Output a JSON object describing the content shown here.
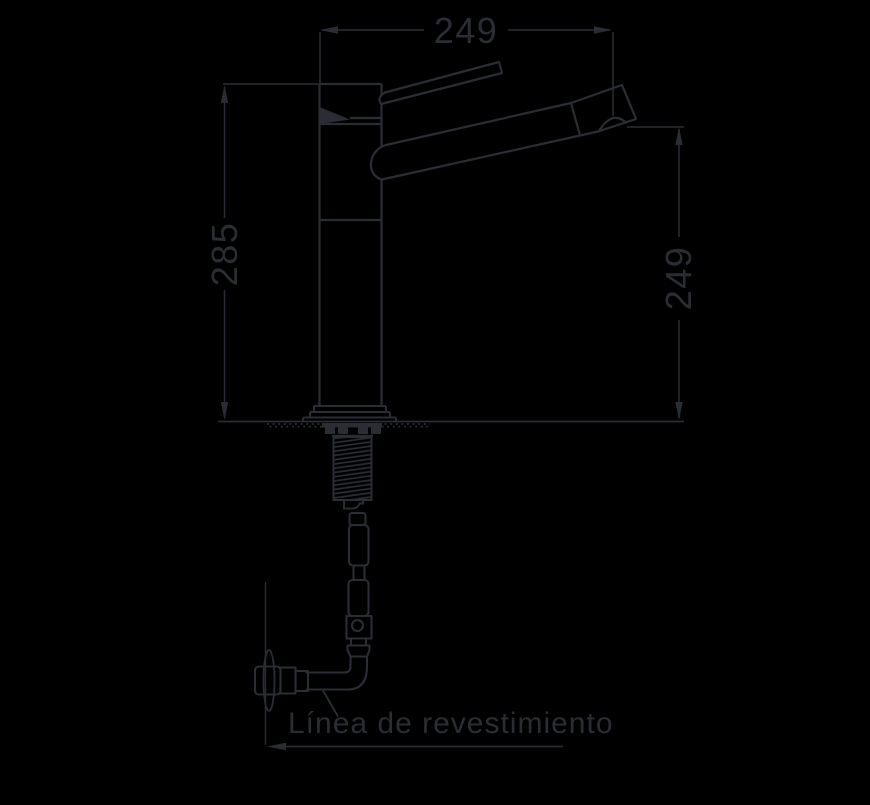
{
  "canvas": {
    "background": "#000000",
    "line_color": "#2a2d34"
  },
  "diagram": {
    "type": "technical-installation-drawing",
    "subject": "kitchen faucet with under-counter supply hose and wall outlet",
    "dimensions": {
      "top_width": "249",
      "left_height": "285",
      "right_height": "249"
    },
    "labels": {
      "coating_line": "Línea de revestimiento"
    }
  }
}
